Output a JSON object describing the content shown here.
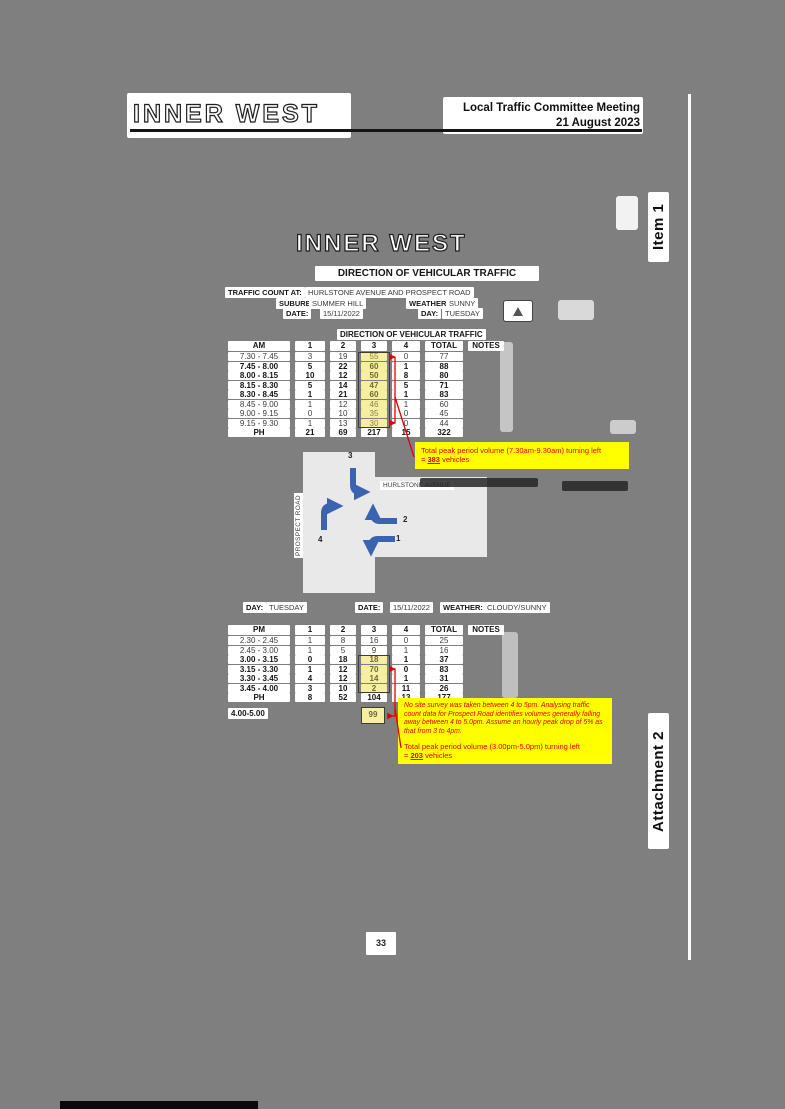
{
  "page_header": {
    "logo_text": "INNER WEST",
    "meeting_title": "Local Traffic Committee Meeting",
    "meeting_date": "21 August 2023"
  },
  "margin": {
    "item_label": "Item 1",
    "attachment_label": "Attachment 2"
  },
  "page_number": "33",
  "scan": {
    "logo_text": "INNER WEST",
    "doc_title": "DIRECTION OF VEHICULAR TRAFFIC",
    "info": {
      "count_label": "TRAFFIC COUNT AT:",
      "count_value": "HURLSTONE AVENUE AND PROSPECT ROAD",
      "suburb_label": "SUBURB:",
      "suburb_value": "SUMMER HILL",
      "weather_label": "WEATHER:",
      "weather_value": "SUNNY",
      "date_label": "DATE:",
      "date_value": "15/11/2022",
      "day_label": "DAY:",
      "day_value": "TUESDAY"
    },
    "am_section_title": "DIRECTION OF VEHICULAR TRAFFIC",
    "am_table": {
      "headers": [
        "AM",
        "1",
        "2",
        "3",
        "4",
        "TOTAL",
        "NOTES"
      ],
      "rows": [
        {
          "time": "7.30 - 7.45",
          "v": [
            "3",
            "19",
            "55",
            "0",
            "77"
          ],
          "bold": false,
          "hl": true
        },
        {
          "time": "7.45 - 8.00",
          "v": [
            "5",
            "22",
            "60",
            "1",
            "88"
          ],
          "bold": true,
          "hl": true
        },
        {
          "time": "8.00 - 8.15",
          "v": [
            "10",
            "12",
            "50",
            "8",
            "80"
          ],
          "bold": true,
          "hl": true
        },
        {
          "time": "8.15 - 8.30",
          "v": [
            "5",
            "14",
            "47",
            "5",
            "71"
          ],
          "bold": true,
          "hl": true
        },
        {
          "time": "8.30 - 8.45",
          "v": [
            "1",
            "21",
            "60",
            "1",
            "83"
          ],
          "bold": true,
          "hl": true
        },
        {
          "time": "8.45 - 9.00",
          "v": [
            "1",
            "12",
            "46",
            "1",
            "60"
          ],
          "bold": false,
          "hl": true
        },
        {
          "time": "9.00 - 9.15",
          "v": [
            "0",
            "10",
            "35",
            "0",
            "45"
          ],
          "bold": false,
          "hl": true
        },
        {
          "time": "9.15 - 9.30",
          "v": [
            "1",
            "13",
            "30",
            "0",
            "44"
          ],
          "bold": false,
          "hl": true
        },
        {
          "time": "PH",
          "v": [
            "21",
            "69",
            "217",
            "15",
            "322"
          ],
          "bold": true,
          "hl": false
        }
      ]
    },
    "am_note": {
      "line1": "Total peak period volume (7.30am-9.30am) turning left",
      "prefix": "= ",
      "value": "383",
      "suffix": " vehicles"
    },
    "diagram": {
      "street_h": "HURLSTONE AVENUE",
      "street_v": "PROSPECT ROAD",
      "m1": "1",
      "m2": "2",
      "m3": "3",
      "m4": "4"
    },
    "pm_info": {
      "day_label": "DAY:",
      "day_value": "TUESDAY",
      "date_label": "DATE:",
      "date_value": "15/11/2022",
      "weather_label": "WEATHER:",
      "weather_value": "CLOUDY/SUNNY"
    },
    "pm_table": {
      "headers": [
        "PM",
        "1",
        "2",
        "3",
        "4",
        "TOTAL",
        "NOTES"
      ],
      "rows": [
        {
          "time": "2.30 - 2.45",
          "v": [
            "1",
            "8",
            "16",
            "0",
            "25"
          ],
          "bold": false,
          "hl": false
        },
        {
          "time": "2.45 - 3.00",
          "v": [
            "1",
            "5",
            "9",
            "1",
            "16"
          ],
          "bold": false,
          "hl": false
        },
        {
          "time": "3.00 - 3.15",
          "v": [
            "0",
            "18",
            "18",
            "1",
            "37"
          ],
          "bold": true,
          "hl": true
        },
        {
          "time": "3.15 - 3.30",
          "v": [
            "1",
            "12",
            "70",
            "0",
            "83"
          ],
          "bold": true,
          "hl": true
        },
        {
          "time": "3.30 - 3.45",
          "v": [
            "4",
            "12",
            "14",
            "1",
            "31"
          ],
          "bold": true,
          "hl": true
        },
        {
          "time": "3.45 - 4.00",
          "v": [
            "3",
            "10",
            "2",
            "11",
            "26"
          ],
          "bold": true,
          "hl": true
        },
        {
          "time": "PH",
          "v": [
            "8",
            "52",
            "104",
            "13",
            "177"
          ],
          "bold": true,
          "hl": false
        }
      ]
    },
    "extra_row": {
      "label": "4.00-5.00",
      "value": "99"
    },
    "pm_note": {
      "para1": "No site survey was taken between 4 to 5pm. Analysing traffic count data for Prospect Road identifies volumes generally falling away between 4 to 5.0pm. Assume an hourly peak drop of 5% as that from 3 to 4pm.",
      "line1": "Total peak period volume (3.00pm-5.0pm) turning left",
      "prefix": "= ",
      "value": "203",
      "suffix": " vehicles"
    }
  },
  "colors": {
    "page_bg": "#7f7f7f",
    "note_bg": "#ffff00",
    "note_text": "#e30000",
    "highlight_bg": "#f6efa2",
    "arrow_blue": "#3b63af",
    "annotation_red": "#e30000",
    "road_bg": "#e9e9e9"
  }
}
